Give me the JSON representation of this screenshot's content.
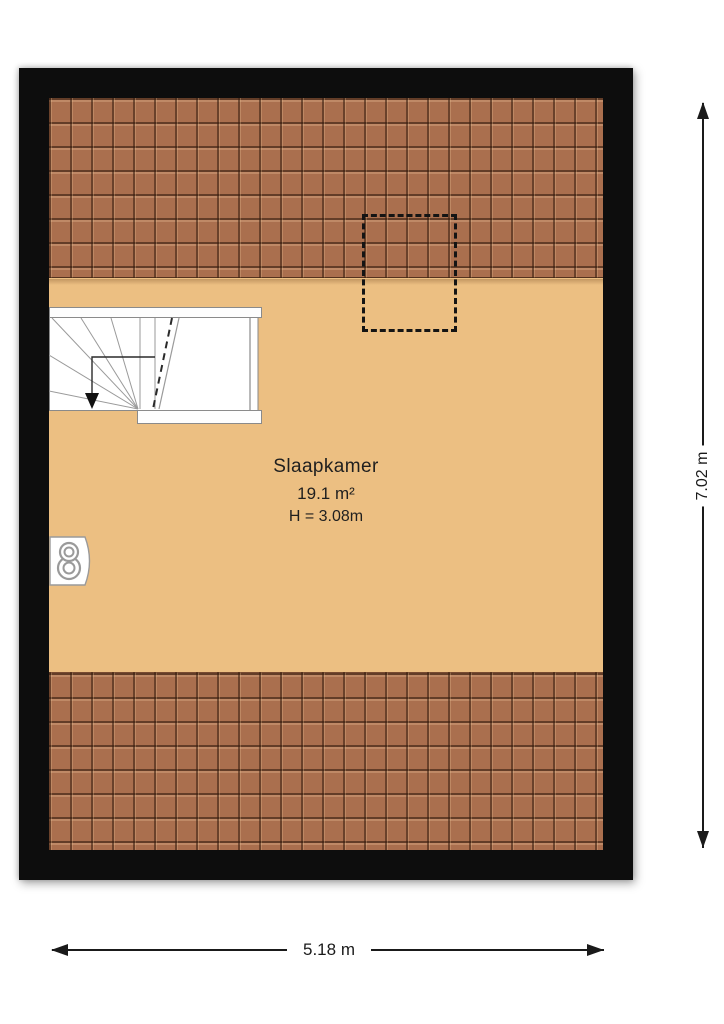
{
  "plan": {
    "title": "attic floor plan",
    "room": {
      "name": "Slaapkamer",
      "area": "19.1 m²",
      "ceiling_height": "H = 3.08m"
    },
    "dimensions": {
      "width": "5.18 m",
      "height": "7.02 m"
    },
    "features": {
      "staircase": "winder staircase with downward walk-line arrow, top-left",
      "skylight": "dashed rectangular roof-opening outline, top-center",
      "heater": "wall-mounted unit with two ventilation circles, left wall",
      "roof_top": "sloped roof tile band along top wall",
      "roof_bottom": "sloped roof tile band along bottom wall"
    },
    "colors": {
      "wall": "#0d0d0d",
      "floor": "#ecbf82",
      "tile_base": "#aa6f4e",
      "tile_grout": "#341c0e",
      "dimension_line": "#1a1a1a",
      "background": "#ffffff"
    }
  }
}
